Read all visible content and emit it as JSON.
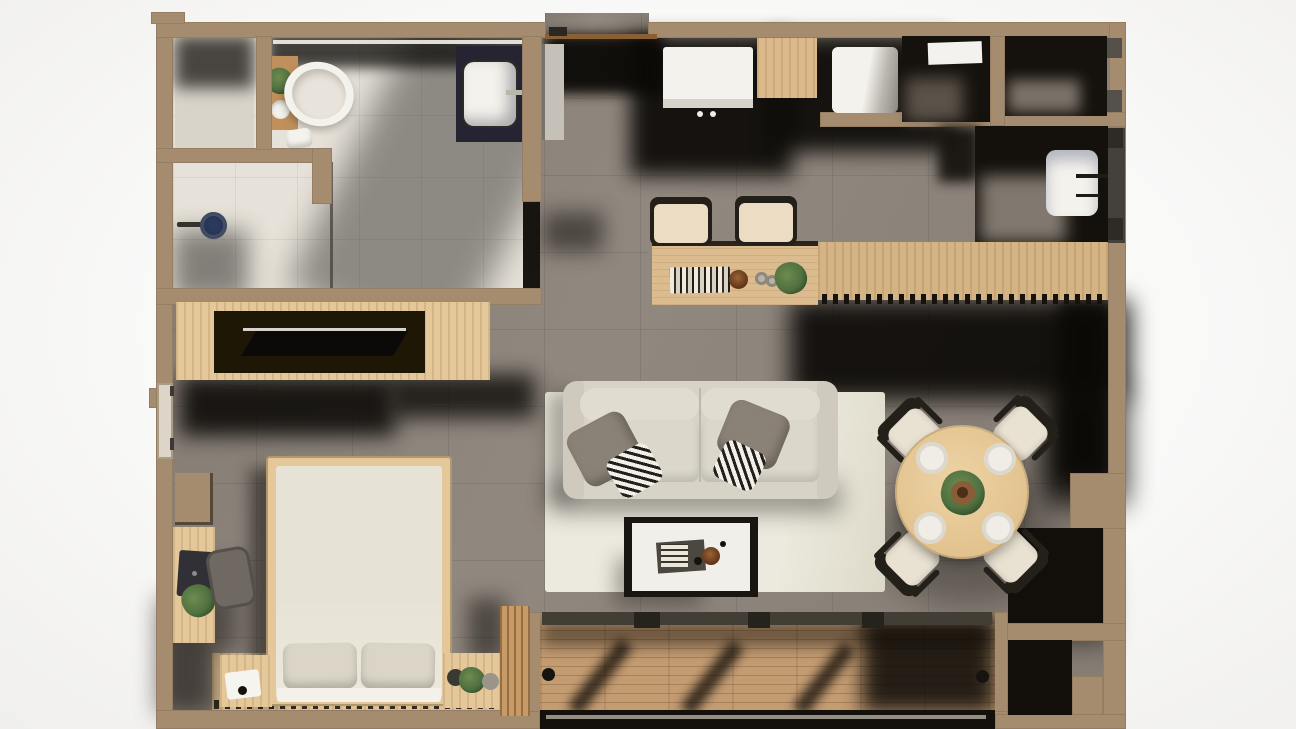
{
  "scene": {
    "title": "Top-down 3D render of a studio apartment floor plan",
    "type": "floor-plan-3d-render",
    "canvas": {
      "width": 1296,
      "height": 729
    }
  },
  "palette": {
    "bg": "#f9f9f8",
    "wall": "#a58c6f",
    "wallDark": "#8c765c",
    "tile": "#8c837a",
    "bath": "#e6e2d9",
    "closetFloor": "#d9d4ca",
    "wood": "#e4c89a",
    "counterWood": "#dcbc8e",
    "counterWood2": "#d4b385",
    "balconyWood": "#c49c72",
    "slatWood": "#c79a66",
    "dark": "#16120d",
    "darker": "#0b0906",
    "navy": "#2c3b5e",
    "white": "#f4f2ec",
    "linen": "#e9e4d8",
    "pillow": "#dbd5c7",
    "sofa": "#d7d3c7",
    "cushion": "#e0dcd0",
    "rug": "#eceade",
    "grayPillow": "#8b8277",
    "green": "#4f7040",
    "greenDark": "#2f4722",
    "pot": "#8a5c38",
    "seat": "#e9e2d2",
    "frame": "#23201a",
    "doorGray": "#45403a",
    "steel": "#b9b6ae",
    "blob": "#8d847a",
    "beam": "#423d35"
  },
  "rooms": {
    "bathroom": {
      "label": "Bathroom",
      "furniture": [
        "bathtub",
        "vanity with plant",
        "washbasin",
        "toilet",
        "walk-in shower with rain head",
        "built-in closet"
      ]
    },
    "entry": {
      "label": "Entry"
    },
    "kitchen": {
      "label": "Kitchen",
      "furniture": [
        "cooktop",
        "kitchen sink",
        "upper wood cabinet",
        "tall cabinet",
        "bar counter",
        "island counter"
      ],
      "bar_stools": 2
    },
    "wardrobes": {
      "label": "Wardrobe closets",
      "count": 2
    },
    "guest_bath": {
      "label": "Guest washroom",
      "furniture": [
        "washbasin with faucet"
      ]
    },
    "living": {
      "label": "Living room",
      "furniture": [
        "sofa",
        "area rug",
        "coffee table",
        "TV media unit"
      ],
      "sofa_pillows": 4
    },
    "dining": {
      "label": "Dining area",
      "furniture": [
        "round dining table",
        "dining chairs",
        "place settings",
        "potted plant"
      ],
      "chairs": 4,
      "plates": 4
    },
    "bedroom": {
      "label": "Bedroom",
      "furniture": [
        "double bed",
        "bed pillows",
        "nightstands",
        "desk",
        "desk chair",
        "laptop",
        "plants",
        "wood slat accent wall"
      ]
    },
    "balcony": {
      "label": "Balcony",
      "furniture": [
        "wood deck",
        "sliding glass doors"
      ],
      "door_handles": 2
    },
    "storage": {
      "label": "Storage niches",
      "count": 2
    }
  }
}
